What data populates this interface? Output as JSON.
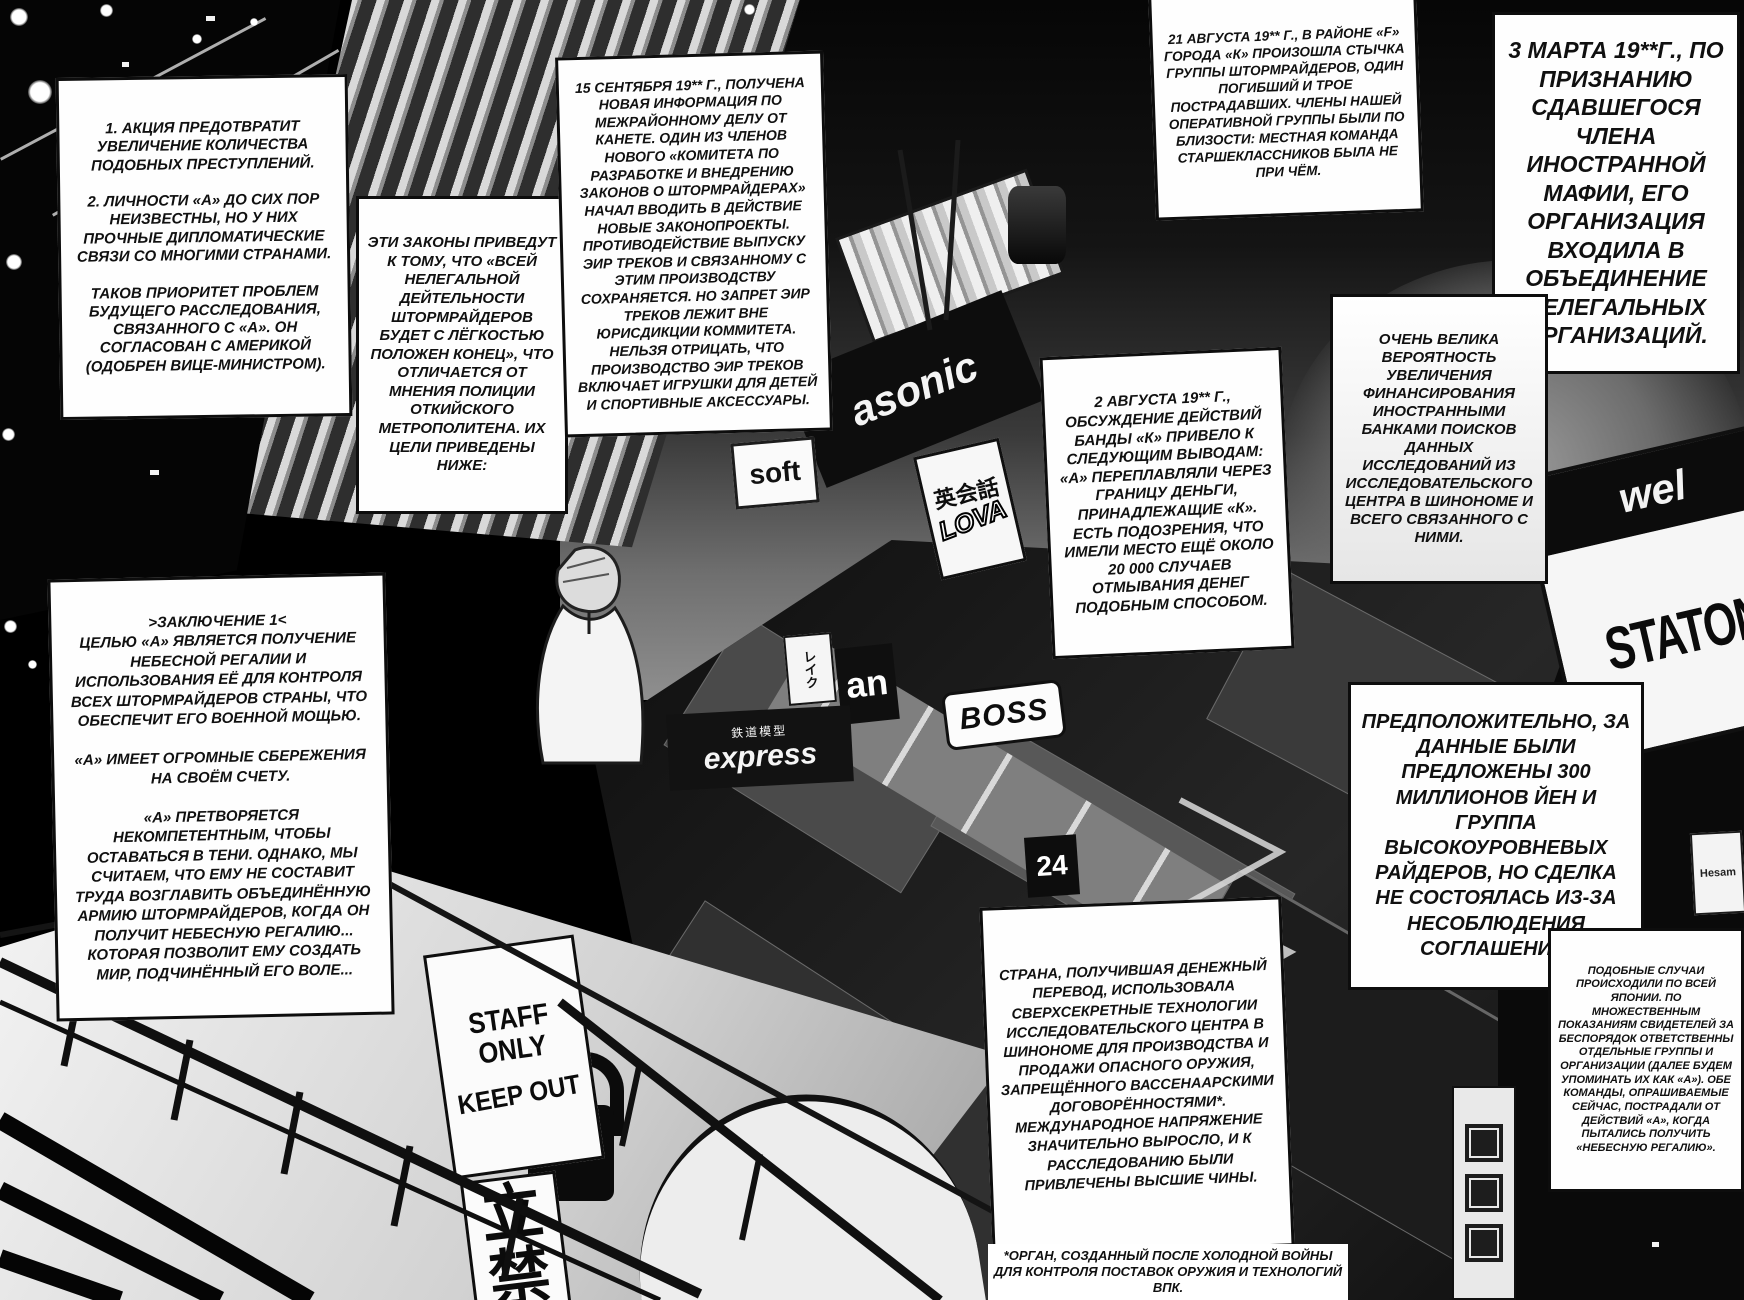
{
  "page": {
    "type": "manga-page",
    "language": "Russian"
  },
  "captions": {
    "action_plan": "1. АКЦИЯ ПРЕДОТВРАТИТ УВЕЛИЧЕНИЕ КОЛИЧЕСТВА ПОДОБНЫХ ПРЕСТУПЛЕНИЙ.\n\n2. ЛИЧНОСТИ «А» ДО СИХ ПОР НЕИЗВЕСТНЫ, НО У НИХ ПРОЧНЫЕ ДИПЛОМАТИЧЕСКИЕ СВЯЗИ СО МНОГИМИ СТРАНАМИ.\n\nТАКОВ ПРИОРИТЕТ ПРОБЛЕМ БУДУЩЕГО РАССЛЕДОВАНИЯ, СВЯЗАННОГО С «А». ОН СОГЛАСОВАН С АМЕРИКОЙ (ОДОБРЕН ВИЦЕ-МИНИСТРОМ).",
    "laws": "ЭТИ ЗАКОНЫ ПРИВЕДУТ К ТОМУ, ЧТО «ВСЕЙ НЕЛЕГАЛЬНОЙ ДЕЙТЕЛЬНОСТИ ШТОРМРАЙДЕРОВ БУДЕТ С ЛЁГКОСТЬЮ ПОЛОЖЕН КОНЕЦ», ЧТО ОТЛИЧАЕТСЯ ОТ МНЕНИЯ ПОЛИЦИИ ОТКИЙСКОГО МЕТРОПОЛИТЕНА. ИХ ЦЕЛИ ПРИВЕДЕНЫ НИЖЕ:",
    "september_report": "15 СЕНТЯБРЯ 19** Г., ПОЛУЧЕНА НОВАЯ ИНФОРМАЦИЯ ПО МЕЖРАЙОННОМУ ДЕЛУ ОТ КАНЕТЕ. ОДИН ИЗ ЧЛЕНОВ НОВОГО «КОМИТЕТА ПО РАЗРАБОТКЕ И ВНЕДРЕНИЮ ЗАКОНОВ О ШТОРМРАЙДЕРАХ» НАЧАЛ ВВОДИТЬ В ДЕЙСТВИЕ НОВЫЕ ЗАКОНОПРОЕКТЫ. ПРОТИВОДЕЙСТВИЕ ВЫПУСКУ ЭИР ТРЕКОВ И СВЯЗАННОМУ С ЭТИМ ПРОИЗВОДСТВУ СОХРАНЯЕТСЯ. НО ЗАПРЕТ ЭИР ТРЕКОВ ЛЕЖИТ ВНЕ ЮРИСДИКЦИИ КОММИТЕТА. НЕЛЬЗЯ ОТРИЦАТЬ, ЧТО ПРОИЗВОДСТВО ЭИР ТРЕКОВ ВКЛЮЧАЕТ ИГРУШКИ ДЛЯ ДЕТЕЙ И СПОРТИВНЫЕ АКСЕССУАРЫ.",
    "august21_report": "21 АВГУСТА 19** Г., В РАЙОНЕ «F» ГОРОДА «К» ПРОИЗОШЛА СТЫЧКА ГРУППЫ ШТОРМРАЙДЕРОВ, ОДИН ПОГИБШИЙ И ТРОЕ ПОСТРАДАВШИХ. ЧЛЕНЫ НАШЕЙ ОПЕРАТИВНОЙ ГРУППЫ БЫЛИ ПО БЛИЗОСТИ: МЕСТНАЯ КОМАНДА СТАРШЕКЛАССНИКОВ БЫЛА НЕ ПРИ ЧЁМ.",
    "march3_report": "3 МАРТА 19**Г., ПО ПРИЗНАНИЮ СДАВШЕГОСЯ ЧЛЕНА ИНОСТРАННОЙ МАФИИ, ЕГО ОРГАНИЗАЦИЯ ВХОДИЛА В ОБЪЕДИНЕНИЕ НЕЛЕГАЛЬНЫХ ОРГАНИЗАЦИЙ.",
    "funding_probability": "ОЧЕНЬ ВЕЛИКА ВЕРОЯТНОСТЬ УВЕЛИЧЕНИЯ ФИНАНСИРОВАНИЯ ИНОСТРАННЫМИ БАНКАМИ ПОИСКОВ ДАННЫХ ИССЛЕДОВАНИЙ ИЗ ИССЛЕДОВАТЕЛЬСКОГО ЦЕНТРА В ШИНОНОМЕ И ВСЕГО СВЯЗАННОГО С НИМИ.",
    "august2_report": "2 АВГУСТА 19** Г., ОБСУЖДЕНИЕ ДЕЙСТВИЙ БАНДЫ «К» ПРИВЕЛО К СЛЕДУЮЩИМ ВЫВОДАМ: «А» ПЕРЕПЛАВЛЯЛИ ЧЕРЕЗ ГРАНИЦУ ДЕНЬГИ, ПРИНАДЛЕЖАЩИЕ «К». ЕСТЬ ПОДОЗРЕНИЯ, ЧТО ИМЕЛИ МЕСТО ЕЩЁ ОКОЛО 20 000 СЛУЧАЕВ ОТМЫВАНИЯ ДЕНЕГ ПОДОБНЫМ СПОСОБОМ.",
    "conclusion": ">ЗАКЛЮЧЕНИЕ 1<\nЦЕЛЬЮ «А» ЯВЛЯЕТСЯ ПОЛУЧЕНИЕ НЕБЕСНОЙ РЕГАЛИИ И ИСПОЛЬЗОВАНИЯ ЕЁ ДЛЯ КОНТРОЛЯ ВСЕХ ШТОРМРАЙДЕРОВ СТРАНЫ, ЧТО ОБЕСПЕЧИТ ЕГО ВОЕННОЙ МОЩЬЮ.\n\n«А» ИМЕЕТ ОГРОМНЫЕ СБЕРЕЖЕНИЯ НА СВОЁМ СЧЕТУ.\n\n«А» ПРЕТВОРЯЕТСЯ НЕКОМПЕТЕНТНЫМ, ЧТОБЫ ОСТАВАТЬСЯ В ТЕНИ. ОДНАКО, МЫ СЧИТАЕМ, ЧТО ЕМУ НЕ СОСТАВИТ ТРУДА ВОЗГЛАВИТЬ ОБЪЕДИНЁННУЮ АРМИЮ ШТОРМРАЙДЕРОВ, КОГДА ОН ПОЛУЧИТ НЕБЕСНУЮ РЕГАЛИЮ... КОТОРАЯ ПОЗВОЛИТ ЕМУ СОЗДАТЬ МИР, ПОДЧИНЁННЫЙ ЕГО ВОЛЕ...",
    "deal": "ПРЕДПОЛОЖИТЕЛЬНО, ЗА ДАННЫЕ БЫЛИ ПРЕДЛОЖЕНЫ 300 МИЛЛИОНОВ ЙЕН И ГРУППА ВЫСОКОУРОВНЕВЫХ РАЙДЕРОВ, НО СДЕЛКА НЕ СОСТОЯЛАСЬ ИЗ-ЗА НЕСОБЛЮДЕНИЯ СОГЛАШЕНИЯ.",
    "similar_cases": "ПОДОБНЫЕ СЛУЧАИ ПРОИСХОДИЛИ ПО ВСЕЙ ЯПОНИИ. ПО МНОЖЕСТВЕННЫМ ПОКАЗАНИЯМ СВИДЕТЕЛЕЙ ЗА БЕСПОРЯДОК ОТВЕТСТВЕННЫ ОТДЕЛЬНЫЕ ГРУППЫ И ОРГАНИЗАЦИИ (ДАЛЕЕ БУДЕМ УПОМИНАТЬ ИХ КАК «А»). ОБЕ КОМАНДЫ, ОПРАШИВАЕМЫЕ СЕЙЧАС, ПОСТРАДАЛИ ОТ ДЕЙСТВИЙ «А», КОГДА ПЫТАЛИСЬ ПОЛУЧИТЬ «НЕБЕСНУЮ РЕГАЛИЮ».",
    "country": "СТРАНА, ПОЛУЧИВШАЯ ДЕНЕЖНЫЙ ПЕРЕВОД, ИСПОЛЬЗОВАЛА СВЕРХСЕКРЕТНЫЕ ТЕХНОЛОГИИ ИССЛЕДОВАТЕЛЬСКОГО ЦЕНТРА В ШИНОНОМЕ ДЛЯ ПРОИЗВОДСТВА И ПРОДАЖИ ОПАСНОГО ОРУЖИЯ, ЗАПРЕЩЁННОГО ВАССЕНААРСКИМИ ДОГОВОРЁННОСТЯМИ*. МЕЖДУНАРОДНОЕ НАПРЯЖЕНИЕ ЗНАЧИТЕЛЬНО ВЫРОСЛО, И К РАССЛЕДОВАНИЮ БЫЛИ ПРИВЛЕЧЕНЫ ВЫСШИЕ ЧИНЫ.",
    "footnote": "*ОРГАН, СОЗДАННЫЙ ПОСЛЕ ХОЛОДНОЙ ВОЙНЫ ДЛЯ КОНТРОЛЯ ПОСТАВОК ОРУЖИЯ И ТЕХНОЛОГИЙ ВПК."
  },
  "signs": {
    "panasonic": "asonic",
    "soft": "soft",
    "eikaiwa": "英会話",
    "lova": "LOVA",
    "reiku": "レイク",
    "an": "an",
    "model_railway": "鉄道模型",
    "express": "express",
    "boss": "BOSS",
    "twenty_four": "24",
    "station_small": "wel",
    "station_big": "STATON",
    "hesam": "Hesam",
    "staff_only": "STAFF\nONLY",
    "keep_out": "KEEP OUT",
    "tachiiri_kinshi": "立\n禁"
  },
  "colors": {
    "ink": "#111111",
    "paper": "#fcfcfc",
    "sky_light": "#8f8f8f"
  }
}
